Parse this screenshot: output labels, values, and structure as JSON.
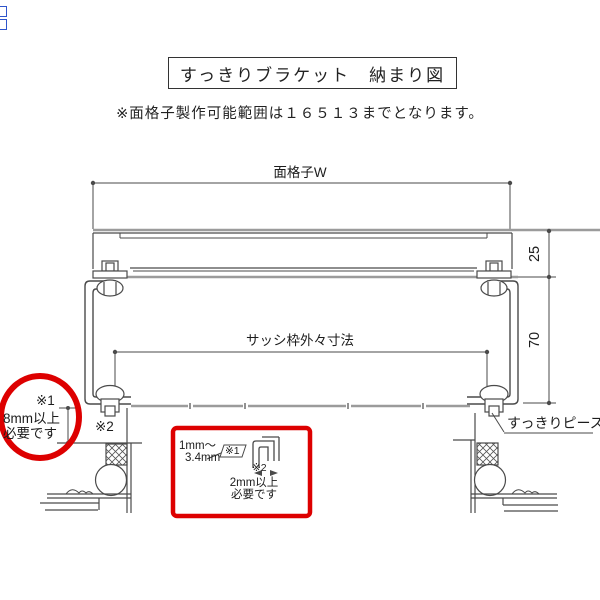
{
  "title": "すっきりブラケット　納まり図",
  "note": "※面格子製作可能範囲は１６５１３までとなります。",
  "diagram": {
    "top_width_label": "面格子W",
    "sash_width_label": "サッシ枠外々寸法",
    "dim_upper": "25",
    "dim_lower": "70",
    "piece_label": "すっきりピース",
    "gap_note": {
      "ref1": "※1",
      "line1": "8mm以上",
      "line2": "必要です",
      "ref2": "※2"
    },
    "detail_box": {
      "range_line1": "1mm～",
      "range_line2": "3.4mm",
      "ref1": "※1",
      "ref2": "※2",
      "req_line1": "2mm以上",
      "req_line2": "必要です"
    }
  },
  "colors": {
    "annotation_red": "#dd0000",
    "line_dark": "#4a4a4a",
    "line_gray": "#9b9b9b",
    "text": "#1c1c1c",
    "edge_artifact_blue": "#2f55cc"
  }
}
